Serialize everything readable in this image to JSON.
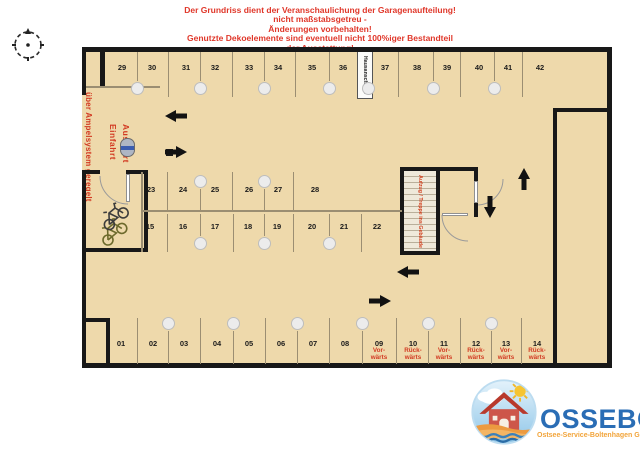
{
  "header": {
    "line1": "Der Grundriss dient der Veranschaulichung der Garagenaufteilung!",
    "line2": "nicht maßstabsgetreu -",
    "line3": "Änderungen vorbehalten!",
    "line4": "Genutzte Dekoelemente sind eventuell nicht 100%iger Bestandteil",
    "line5": "der Ausstattung!"
  },
  "plan": {
    "entrance_regulation_label": "über Ampelsystem geregelt",
    "entrance_label_line1": "Einfahrt",
    "entrance_label_line2": "Ausfahrt",
    "house_connection_label": "Hausanschluss",
    "elevator_label": "Aufzug / Treppe ins Gebäude",
    "spaces_top_row": [
      "29",
      "30",
      "31",
      "32",
      "33",
      "34",
      "35",
      "36",
      "37",
      "38",
      "39",
      "40",
      "41",
      "42"
    ],
    "spaces_island_top": [
      "23",
      "24",
      "25",
      "26",
      "27",
      "28"
    ],
    "spaces_island_bottom": [
      "15",
      "16",
      "17",
      "18",
      "19",
      "20",
      "21",
      "22"
    ],
    "spaces_bottom_row": [
      {
        "num": "01"
      },
      {
        "num": "02"
      },
      {
        "num": "03"
      },
      {
        "num": "04"
      },
      {
        "num": "05"
      },
      {
        "num": "06"
      },
      {
        "num": "07"
      },
      {
        "num": "08"
      },
      {
        "num": "09",
        "dir": "forward"
      },
      {
        "num": "10",
        "dir": "backward"
      },
      {
        "num": "11",
        "dir": "forward"
      },
      {
        "num": "12",
        "dir": "backward"
      },
      {
        "num": "13",
        "dir": "forward"
      },
      {
        "num": "14",
        "dir": "backward"
      }
    ],
    "direction_labels": {
      "forward": "Vor-\nwärts",
      "backward": "Rück-\nwärts"
    }
  },
  "logo": {
    "name": "OSSEBO",
    "subtitle": "Ostsee-Service-Boltenhagen GmbH"
  },
  "colors": {
    "floor": "#eed9ab",
    "wall": "#181818",
    "accent_red": "#d23a22",
    "logo_blue": "#2a6db5",
    "logo_orange": "#f2a43a"
  }
}
